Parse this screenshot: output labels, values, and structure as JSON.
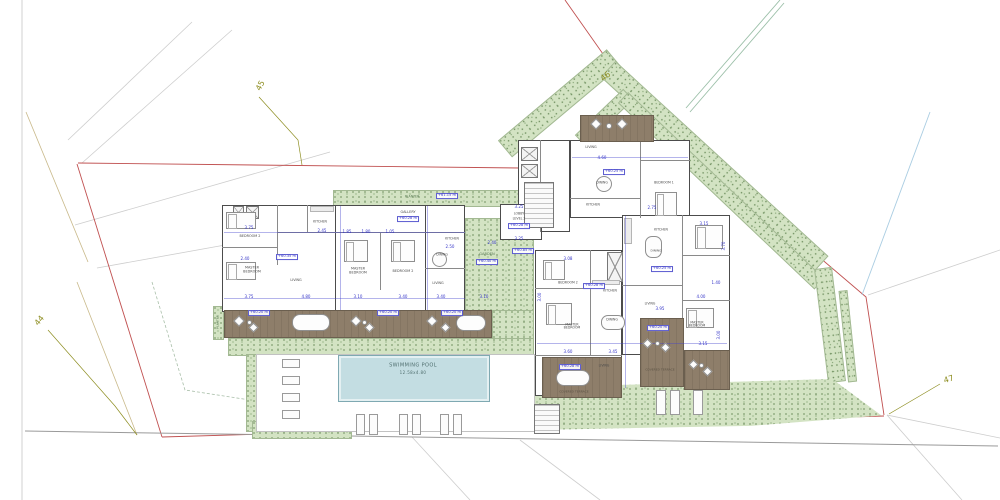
{
  "site": {
    "pt44": "44",
    "pt45": "45",
    "pt46": "46",
    "pt47": "47"
  },
  "planter_top": {
    "label": "PLANTER",
    "level": "+61.15 m"
  },
  "planter_side": {
    "label": "PLANTER"
  },
  "pool": {
    "name": "SWIMMING POOL",
    "size": "12.58x4.80"
  },
  "garden": {
    "name": "GARDEN",
    "level": "+60.40 m"
  },
  "gallery": {
    "name": "GALLERY",
    "level": "+60.28 m"
  },
  "lobby": {
    "name": "LOBBY",
    "floor": "LEVEL 2",
    "level": "+60.28 m",
    "dim_top": "3.25",
    "dim_bottom": "3.25",
    "level_below": "+60.85 m"
  },
  "unit_a": {
    "bedroom2": "BEDROOM 2",
    "master": "MASTER BEDROOM",
    "living": "LIVING",
    "kitchen": "KITCHEN",
    "level": "+60.35 m",
    "terrace_level": "+60.20 m",
    "dims": {
      "top": "3.75",
      "kitchen": "2.45",
      "bath": "2.40",
      "bottom1": "3.75",
      "bottom2": "4.80"
    }
  },
  "unit_b": {
    "master": "MASTER BEDROOM",
    "bedroom2": "BEDROOM 2",
    "terrace_level": "+60.20 m",
    "dims": {
      "d1": "1.85",
      "d2": "1.80",
      "d3": "1.05",
      "bottom1": "3.10",
      "bottom2": "3.40"
    }
  },
  "unit_c": {
    "kitchen": "KITCHEN",
    "dining": "DINING",
    "living": "LIVING",
    "terrace_level": "+60.20 m",
    "dims": {
      "kitchen": "2.50",
      "garden": "2.40",
      "bottom1": "3.40",
      "bottom2": "3.10"
    }
  },
  "unit_top": {
    "living": "LIVING",
    "dining": "DINING",
    "kitchen": "KITCHEN",
    "bedroom1": "BEDROOM 1",
    "level": "+60.25 m",
    "dims": {
      "living": "4.60",
      "bedroom": "2.75",
      "bed2_w": "3.15",
      "bed2_h": "3.70"
    }
  },
  "unit_d": {
    "bedroom2": "BEDROOM 2",
    "master": "MASTER BEDROOM",
    "kitchen": "KITCHEN",
    "dining": "DINING",
    "living": "LIVING",
    "terrace": "COVERED TERRACE",
    "kitchen_level": "+60.28 m",
    "terrace_level": "+60.28 m",
    "dims": {
      "top": "3.08",
      "master": "3.60",
      "living": "3.45",
      "side": "3.00"
    }
  },
  "unit_e": {
    "kitchen": "KITCHEN",
    "dining": "DINING",
    "living": "LIVING",
    "master": "MASTER BEDROOM",
    "terrace": "COVERED TERRACE",
    "dining_level": "+60.25 m",
    "terrace_level": "+60.20 m",
    "dims": {
      "living": "3.95",
      "master_w": "3.15",
      "master_h": "3.00",
      "d1": "4.00",
      "d2": "1.40"
    }
  }
}
